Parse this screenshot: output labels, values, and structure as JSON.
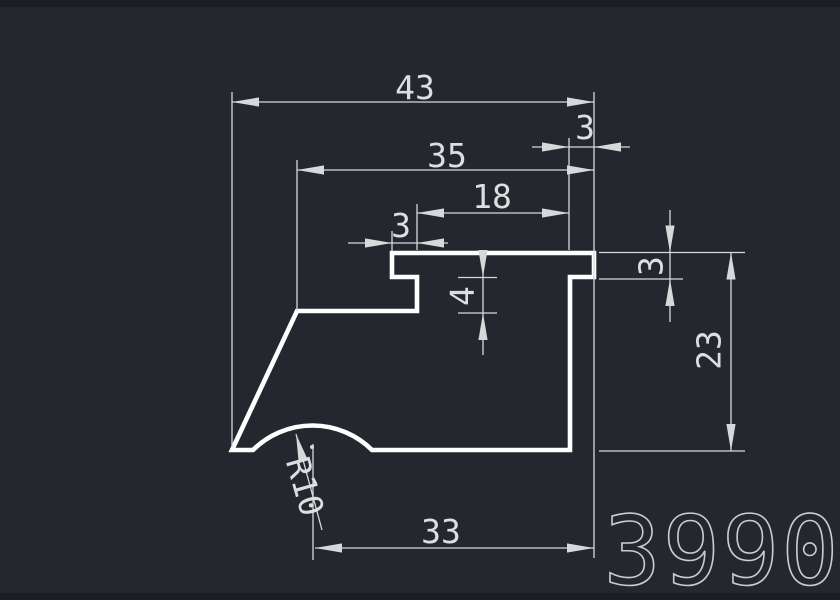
{
  "canvas": {
    "background": "#24272d",
    "edge_strip": "#1b1e23",
    "profile_color": "#ffffff",
    "dim_color": "#d6d8da",
    "text_color": "#dcdee0",
    "part_number_color": "#c9cdd1"
  },
  "part_number": "3990",
  "dimensions": {
    "overall_width": "43",
    "upper_width": "35",
    "right_overhang": "3",
    "notch_span": "18",
    "left_notch": "3",
    "step_depth": "4",
    "flange_thickness": "3",
    "body_height": "23",
    "bottom_width": "33",
    "groove_radius": "R10"
  }
}
